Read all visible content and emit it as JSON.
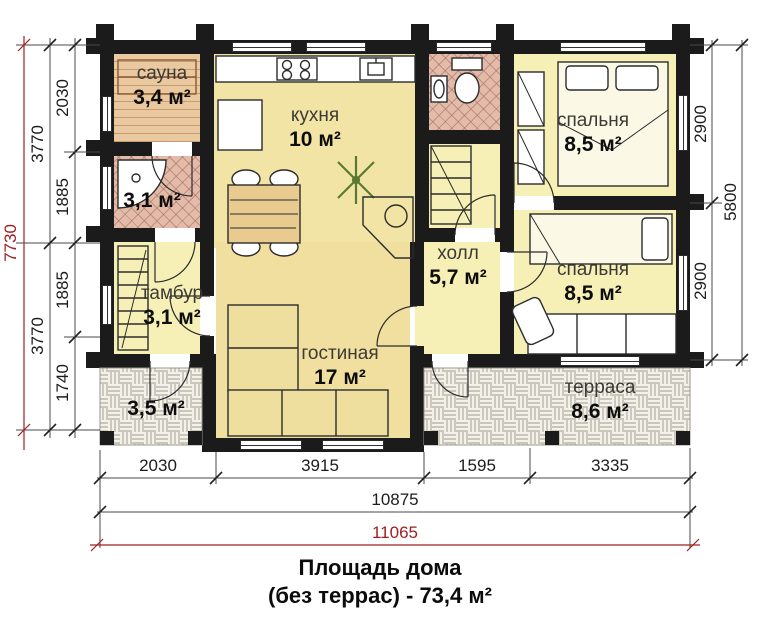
{
  "title": {
    "line1": "Площадь дома",
    "line2": "(без террас) - 73,4 м²"
  },
  "rooms": {
    "sauna": {
      "name": "сауна",
      "area": "3,4 м²"
    },
    "shower": {
      "name": "",
      "area": "3,1 м²"
    },
    "tambour": {
      "name": "тамбур",
      "area": "3,1 м²"
    },
    "kitchen": {
      "name": "кухня",
      "area": "10 м²"
    },
    "living": {
      "name": "гостиная",
      "area": "17 м²"
    },
    "hall": {
      "name": "холл",
      "area": "5,7 м²"
    },
    "bedroom1": {
      "name": "спальня",
      "area": "8,5 м²"
    },
    "bedroom2": {
      "name": "спальня",
      "area": "8,5 м²"
    },
    "terrace_small": {
      "name": "",
      "area": "3,5 м²"
    },
    "terrace": {
      "name": "терраса",
      "area": "8,6 м²"
    }
  },
  "dims": {
    "left_total": "7730",
    "left_mid": [
      "3770",
      "3770"
    ],
    "left_inner": [
      "2030",
      "1885",
      "1885",
      "1740"
    ],
    "right_inner": [
      "2900",
      "2900"
    ],
    "right_total": "5800",
    "bottom_inner": [
      "2030",
      "3915",
      "1595",
      "3335"
    ],
    "bottom_mid": "10875",
    "bottom_total": "11065"
  },
  "colors": {
    "wall": "#1b1b1b",
    "dim_red": "#9e2020",
    "room_yellow": "#f7f0b6",
    "room_gold": "#f2e4a4",
    "sauna_tan": "#eac9a0",
    "tile_pink": "#e3bca9",
    "terrace_bg": "#f4f1ea"
  }
}
